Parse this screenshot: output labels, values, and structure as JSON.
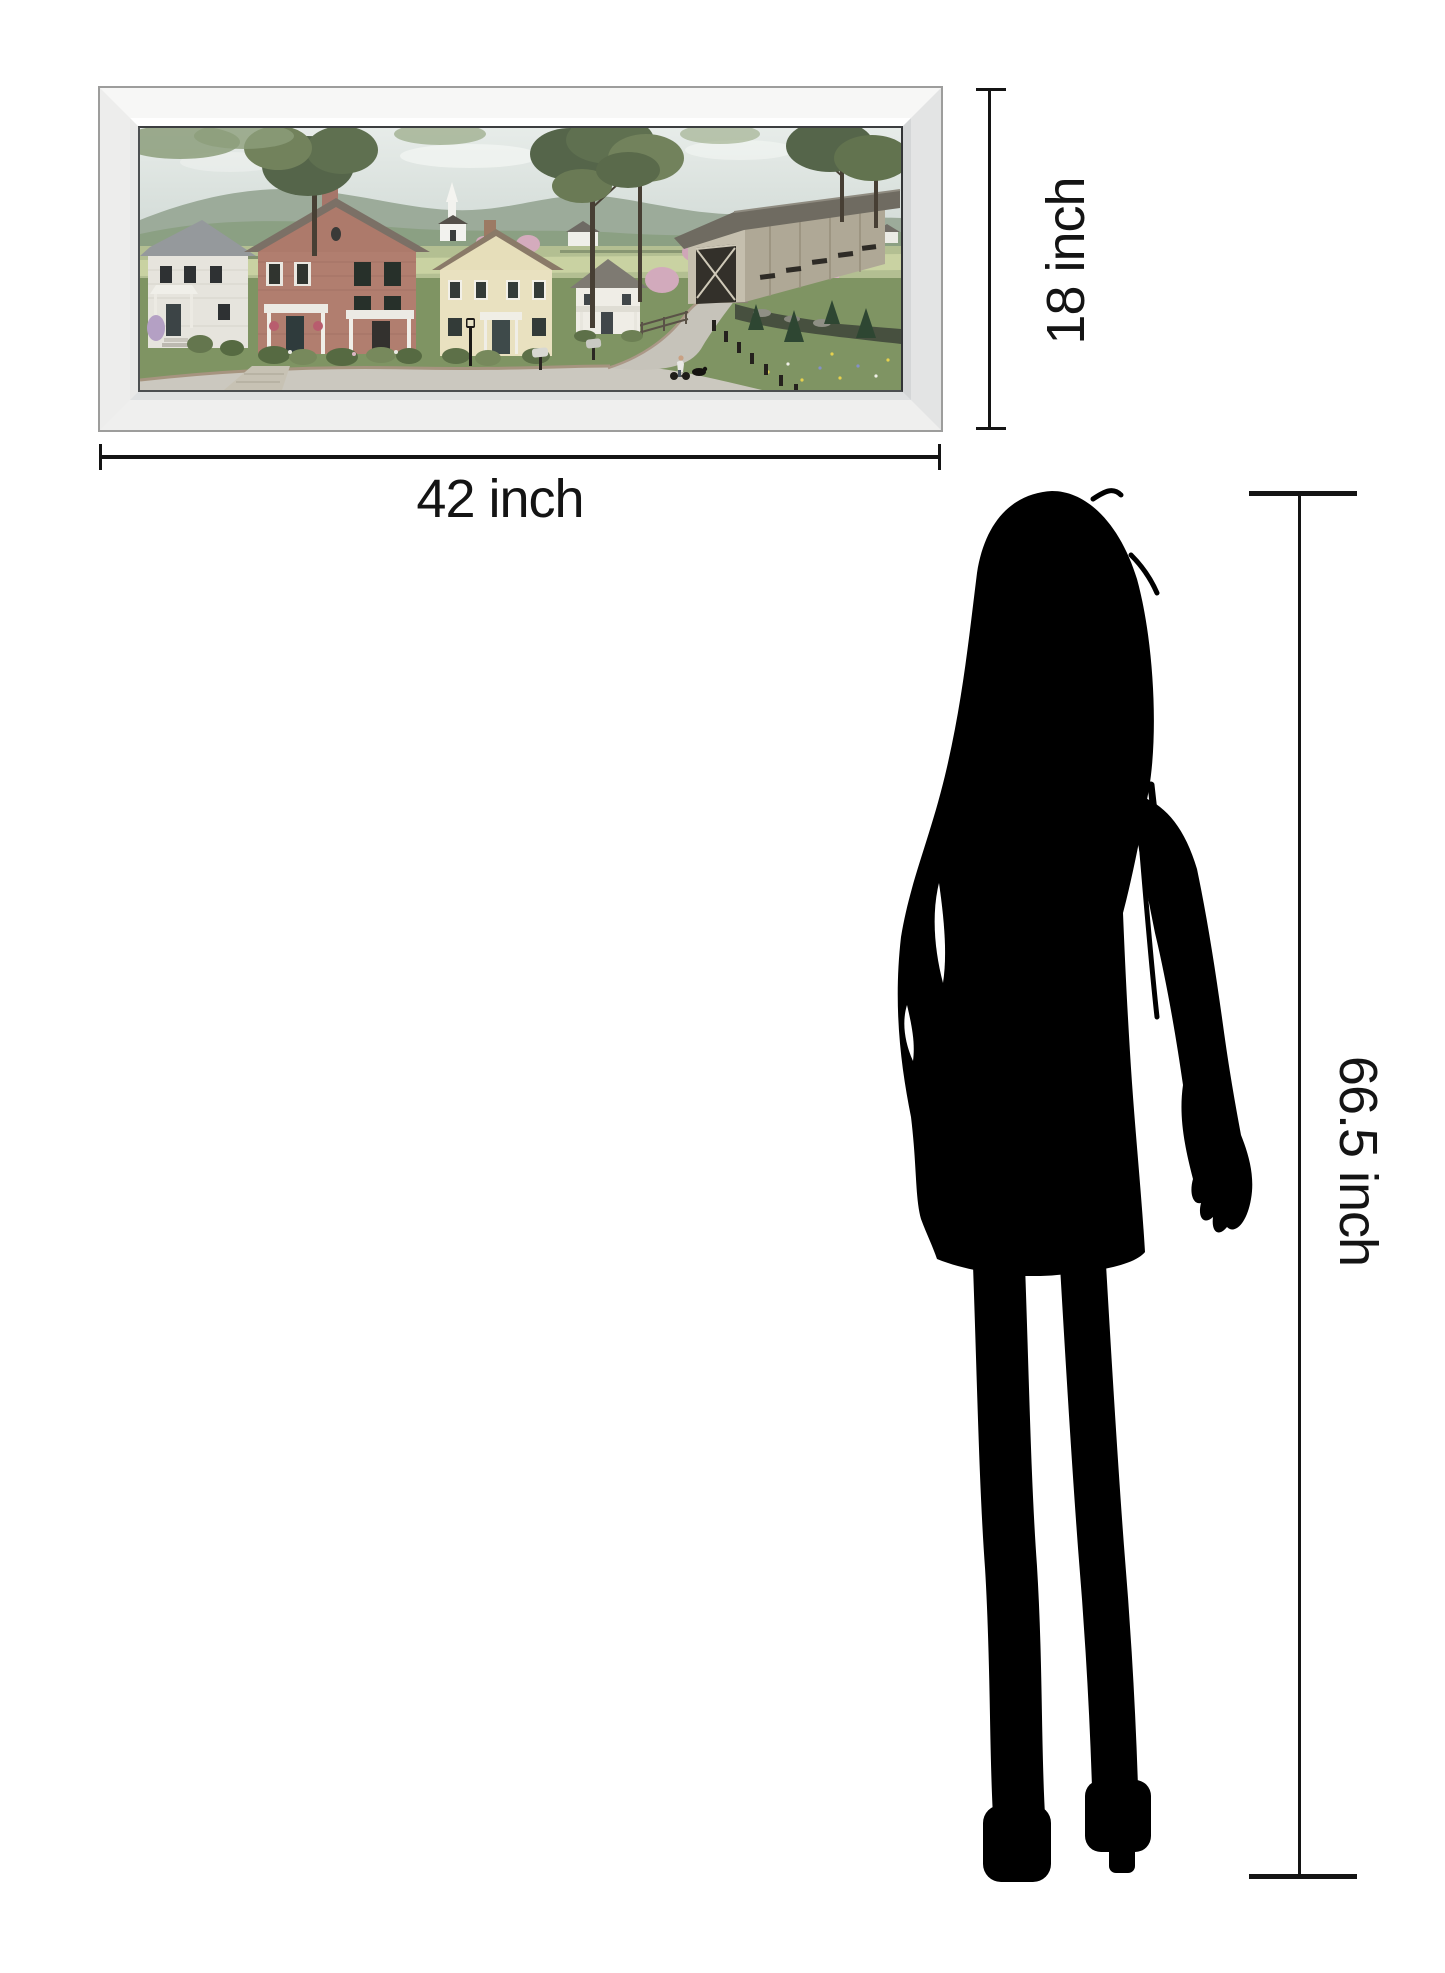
{
  "page": {
    "type": "product size comparison diagram",
    "background": "#ffffff"
  },
  "artwork": {
    "alt": "Framed panoramic print of a country village: white and red-brick houses with porches, a cream colonial house, a white church steeple, farmhouses and a barn on green hills, pink flowering trees, tall dark trees, a winding gray road lined with fence posts, a weathered covered bridge over a stream, and a boy riding a bicycle with a black dog",
    "frame_style": "beveled mirror frame"
  },
  "dimensions": {
    "width_label": "42 inch",
    "height_label": "18 inch",
    "person_height_label": "66.5 inch"
  },
  "figure": {
    "alt": "black silhouette of a standing woman shown for scale"
  },
  "colors": {
    "line_color": "#141414",
    "silhouette_color": "#000000",
    "frame_silver": "#f2f2f1",
    "page_bg": "#ffffff"
  }
}
